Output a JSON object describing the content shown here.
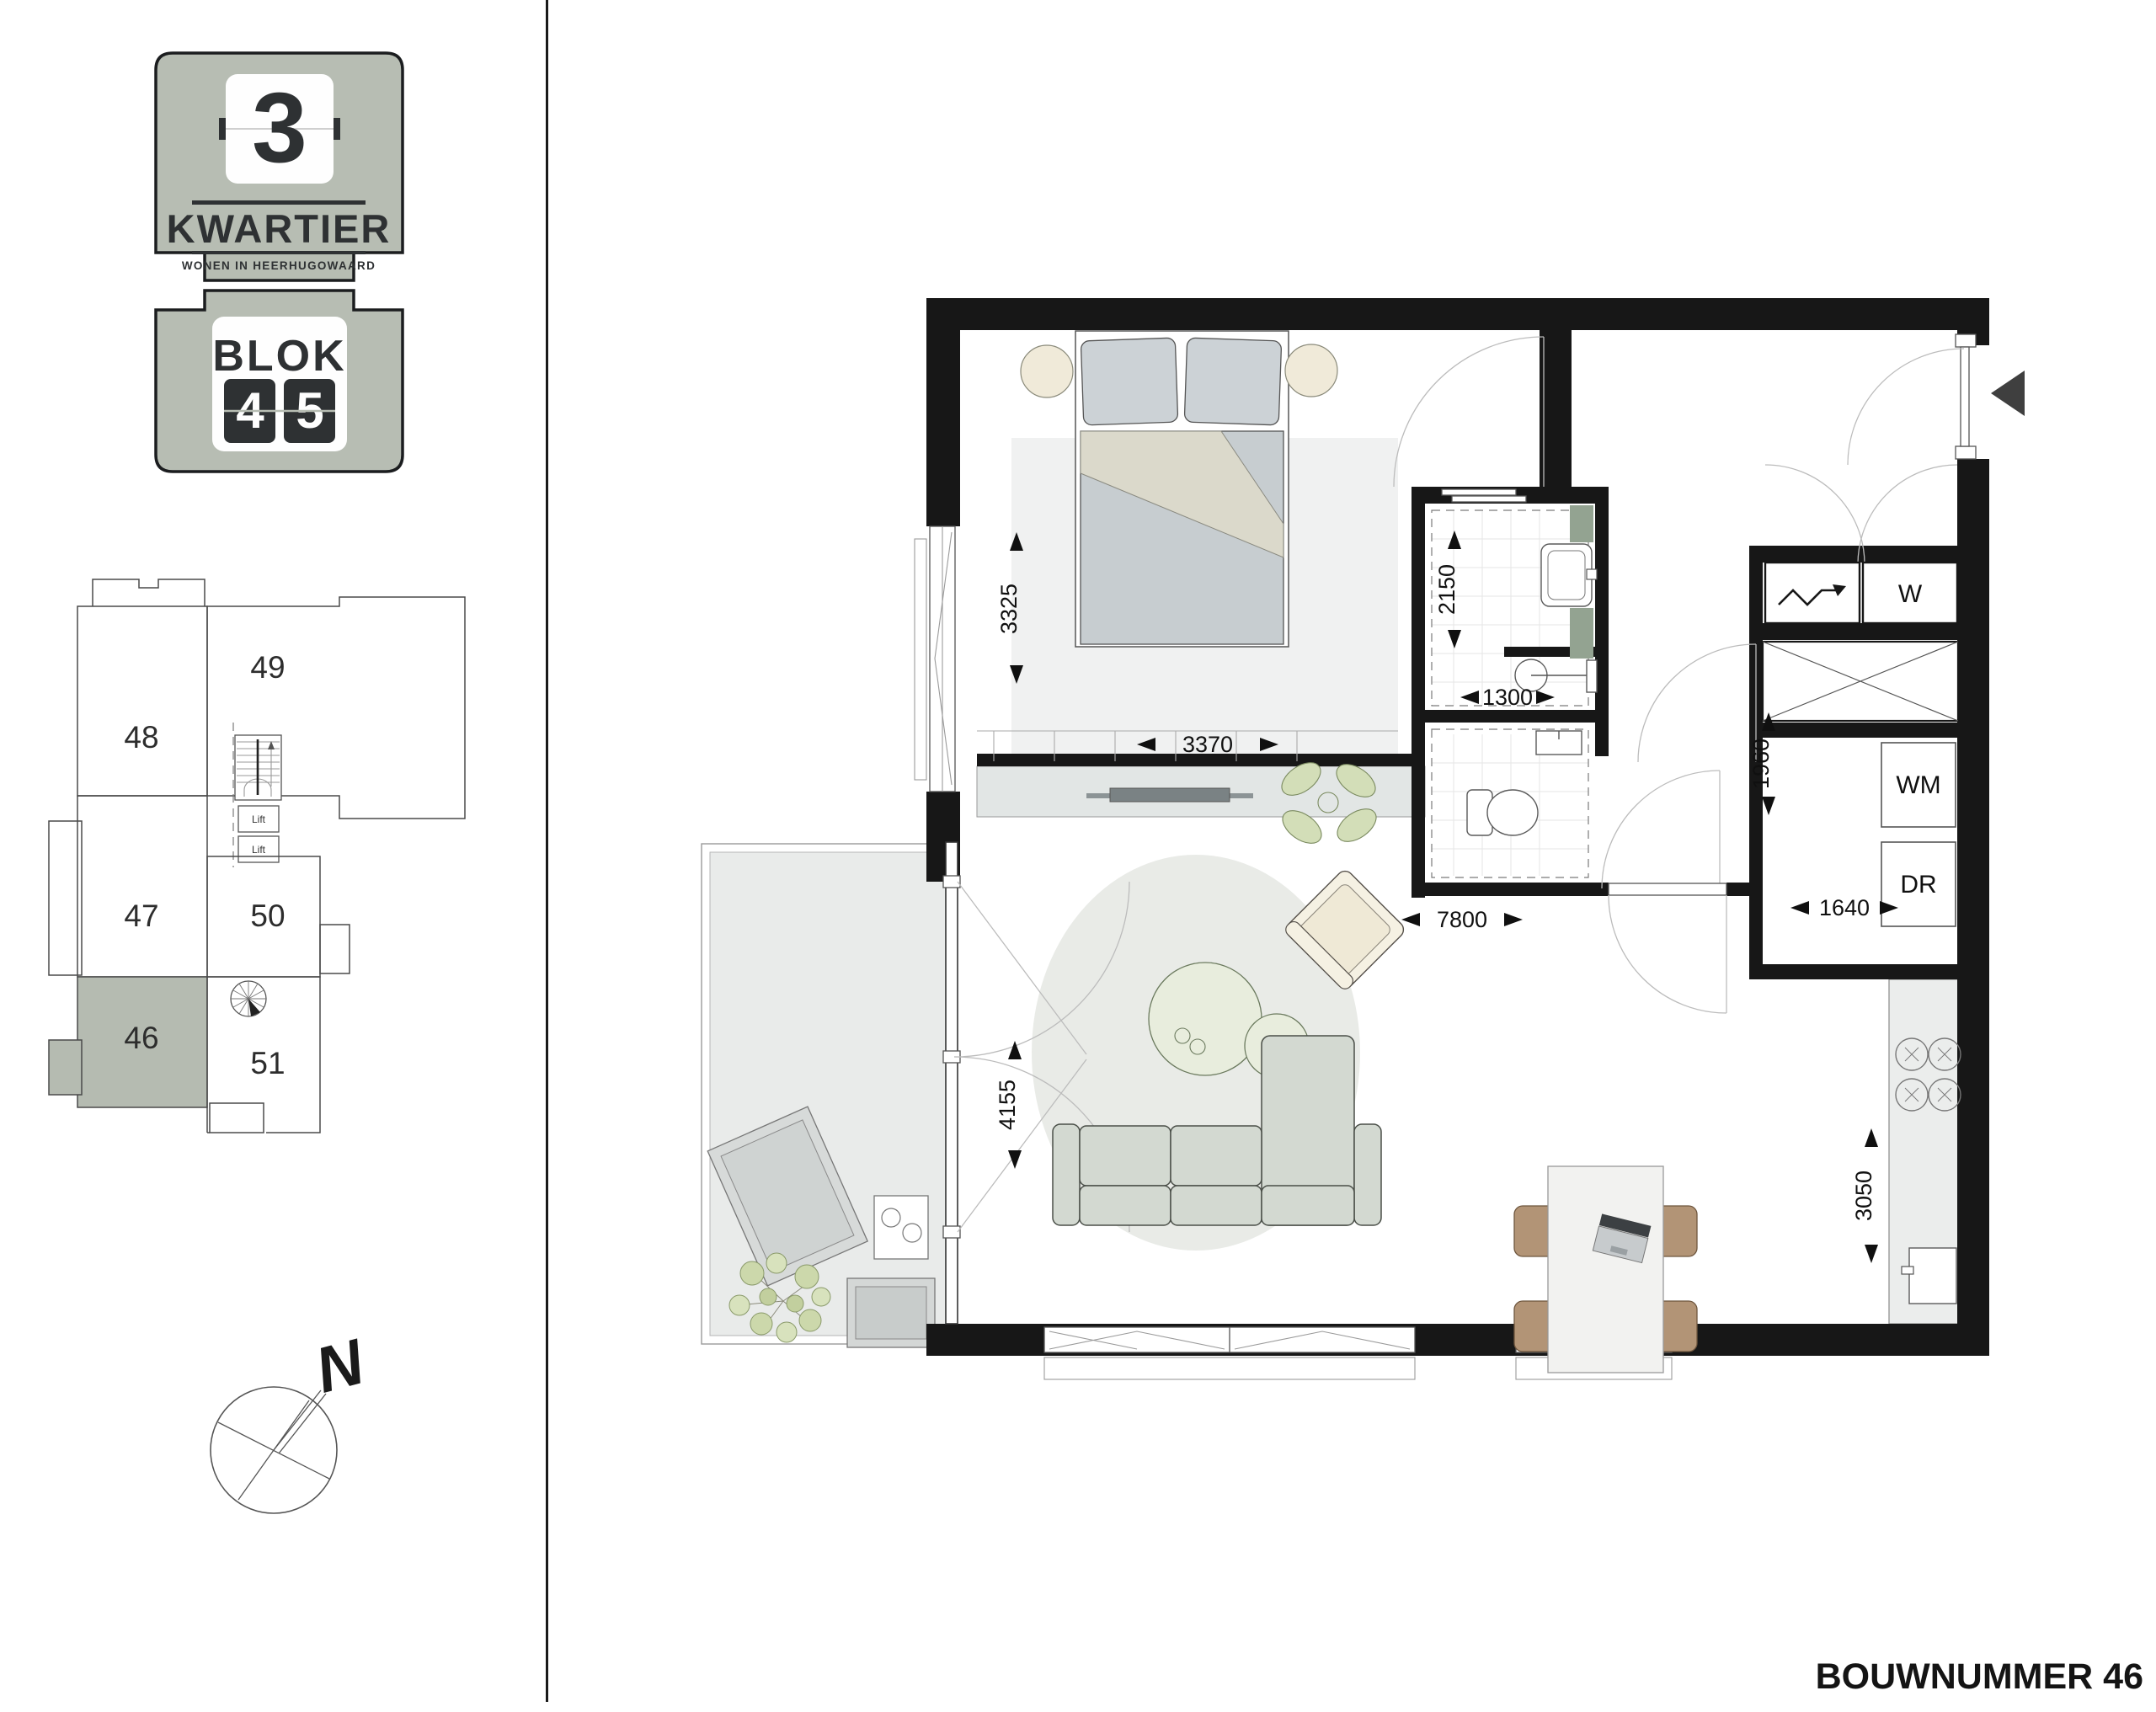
{
  "logo": {
    "project_number": "3",
    "project_name": "KWARTIER",
    "tagline": "WONEN IN HEERHUGOWAARD",
    "block_label": "BLOK",
    "block_digits": [
      "4",
      "5"
    ]
  },
  "site_plan": {
    "highlighted_unit": "46",
    "units": [
      {
        "number": "49",
        "highlighted": false
      },
      {
        "number": "48",
        "highlighted": false
      },
      {
        "number": "47",
        "highlighted": false
      },
      {
        "number": "50",
        "highlighted": false
      },
      {
        "number": "46",
        "highlighted": true
      },
      {
        "number": "51",
        "highlighted": false
      }
    ],
    "lifts": [
      {
        "label": "Lift"
      },
      {
        "label": "Lift"
      }
    ]
  },
  "compass": {
    "north_label": "N"
  },
  "floor_plan": {
    "dimensions": {
      "bedroom_depth": "3325",
      "bedroom_width": "3370",
      "bathroom_depth": "2150",
      "bathroom_width": "1300",
      "living_width": "7800",
      "living_depth": "4155",
      "storage_depth": "1960",
      "storage_width": "1640",
      "kitchen_depth": "3050"
    },
    "labels": {
      "water_heater": "W",
      "washing_machine": "WM",
      "dryer": "DR"
    }
  },
  "footer": {
    "build_number": "BOUWNUMMER 46"
  },
  "colors": {
    "accent_green_gray": "#b7bdb3",
    "highlight_unit": "#b5bbb1",
    "wall_black": "#171717",
    "tile_green": "#93a391",
    "sofa_green_gray": "#d3d9d1",
    "chair_brown": "#b29476",
    "cream": "#f0ead9"
  }
}
